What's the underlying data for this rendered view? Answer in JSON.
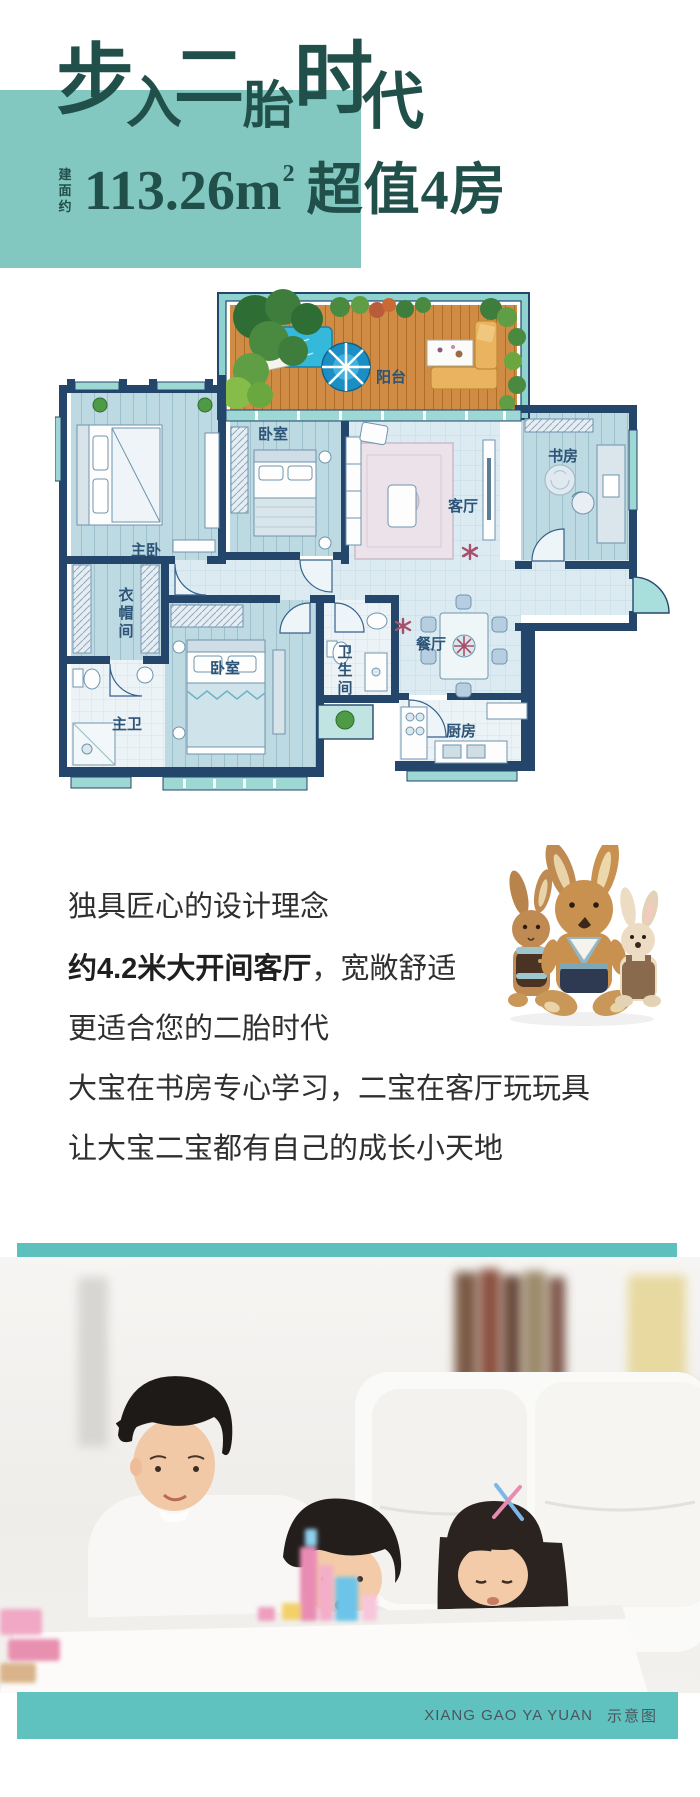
{
  "header": {
    "title_chars": [
      "步",
      "入",
      "二",
      "胎",
      "时",
      "代"
    ],
    "area_prefix_chars": [
      "建",
      "面",
      "约"
    ],
    "area_main": "113.26m",
    "area_sup": "2",
    "area_tail": "超值4房",
    "accent_dark": "#21504a",
    "accent_teal": "#83c7c1"
  },
  "floor_plan": {
    "labels": {
      "balcony": "阳台",
      "bedroom_top": "卧室",
      "study": "书房",
      "living": "客厅",
      "master": "主卧",
      "master_bath": "主卫",
      "bedroom_bottom": "卧室",
      "dining": "餐厅",
      "kitchen": "厨房"
    },
    "cloak_chars": [
      "衣",
      "帽",
      "间"
    ],
    "bath_chars": [
      "卫",
      "生",
      "间"
    ],
    "wall_color": "#24466b",
    "window_color": "#9ed8d5"
  },
  "body": {
    "lines": [
      {
        "bold": "",
        "text": "独具匠心的设计理念"
      },
      {
        "bold": "约4.2米大开间客厅",
        "text": "，宽敞舒适"
      },
      {
        "bold": "",
        "text": "更适合您的二胎时代"
      },
      {
        "bold": "",
        "text": "大宝在书房专心学习，二宝在客厅玩玩具"
      },
      {
        "bold": "",
        "text": "让大宝二宝都有自己的成长小天地"
      }
    ]
  },
  "footer": {
    "caption_en": "XIANG GAO YA YUAN",
    "caption_cn": "示意图",
    "band_color": "#5fc2be"
  }
}
